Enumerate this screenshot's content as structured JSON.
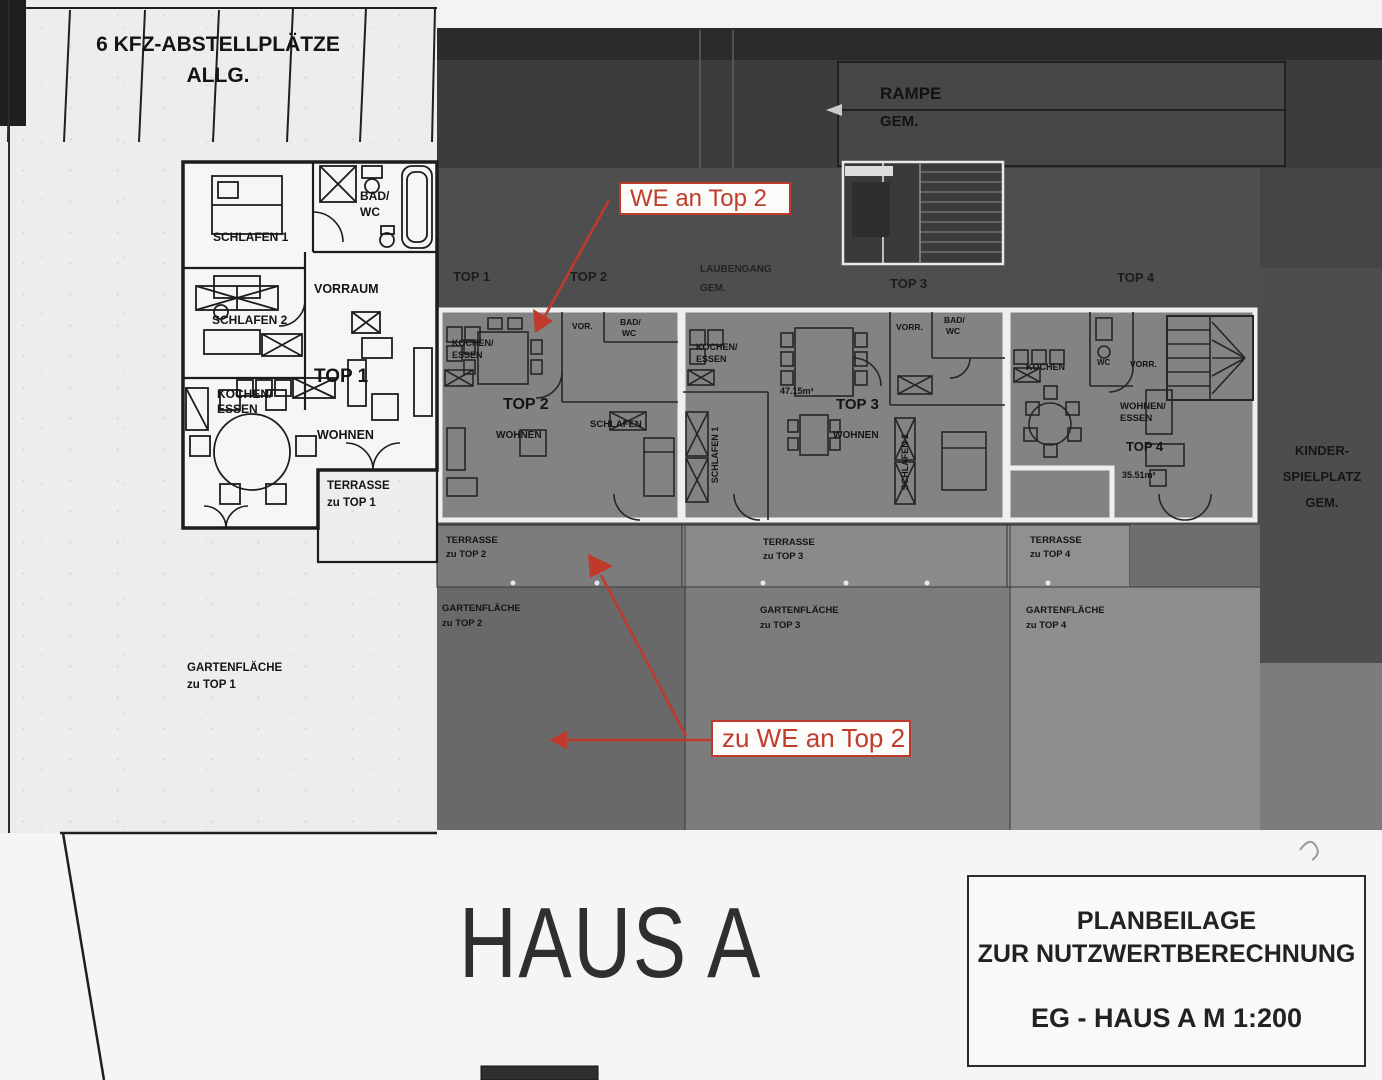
{
  "annotation_color": "#bf3a2c",
  "parking": {
    "line1": "6 KFZ-ABSTELLPLÄTZE",
    "line2": "ALLG."
  },
  "ramp": {
    "name": "RAMPE",
    "suffix": "GEM."
  },
  "corridor": {
    "name": "LAUBENGANG",
    "suffix": "GEM."
  },
  "band": {
    "top1": "TOP 1",
    "top2": "TOP 2",
    "top3": "TOP 3",
    "top4": "TOP 4"
  },
  "playground": {
    "line1": "KINDER-",
    "line2": "SPIELPLATZ",
    "line3": "GEM."
  },
  "unit1": {
    "schlafen1": "SCHLAFEN 1",
    "bad": "BAD/",
    "wc": "WC",
    "schlafen2": "SCHLAFEN 2",
    "vorraum": "VORRAUM",
    "name": "TOP 1",
    "kochen": "KOCHEN/",
    "essen": "ESSEN",
    "wohnen": "WOHNEN",
    "terrasse_l1": "TERRASSE",
    "terrasse_l2": "zu TOP 1",
    "garten_l1": "GARTENFLÄCHE",
    "garten_l2": "zu TOP 1"
  },
  "unit2": {
    "kochen": "KOCHEN/",
    "essen": "ESSEN",
    "vor": "VOR.",
    "bad": "BAD/",
    "wc": "WC",
    "name": "TOP 2",
    "wohnen": "WOHNEN",
    "schlafen": "SCHLAFEN",
    "terrasse_l1": "TERRASSE",
    "terrasse_l2": "zu TOP 2",
    "garten_l1": "GARTENFLÄCHE",
    "garten_l2": "zu TOP 2"
  },
  "unit3": {
    "kochen": "KOCHEN/",
    "essen": "ESSEN",
    "area": "47.15m²",
    "name": "TOP 3",
    "wohnen": "WOHNEN",
    "schlafen1": "SCHLAFEN 1",
    "schlafen2": "SCHLAFEN 2",
    "vorr": "VORR.",
    "bad": "BAD/",
    "wc": "WC",
    "terrasse_l1": "TERRASSE",
    "terrasse_l2": "zu TOP 3",
    "garten_l1": "GARTENFLÄCHE",
    "garten_l2": "zu TOP 3"
  },
  "unit4": {
    "kochen": "KOCHEN",
    "wc": "WC",
    "vorr": "VORR.",
    "wohnen": "WOHNEN/",
    "essen": "ESSEN",
    "name": "TOP 4",
    "area": "35.51m²",
    "terrasse_l1": "TERRASSE",
    "terrasse_l2": "zu TOP 4",
    "garten_l1": "GARTENFLÄCHE",
    "garten_l2": "zu TOP 4"
  },
  "annotations": {
    "we_an_top2": "WE an Top 2",
    "zu_we_an_top2": "zu WE an Top 2"
  },
  "footer": {
    "house": "HAUS A"
  },
  "titleblock": {
    "line1": "PLANBEILAGE",
    "line2": "ZUR NUTZWERTBERECHNUNG",
    "line3": "EG - HAUS A M 1:200"
  }
}
